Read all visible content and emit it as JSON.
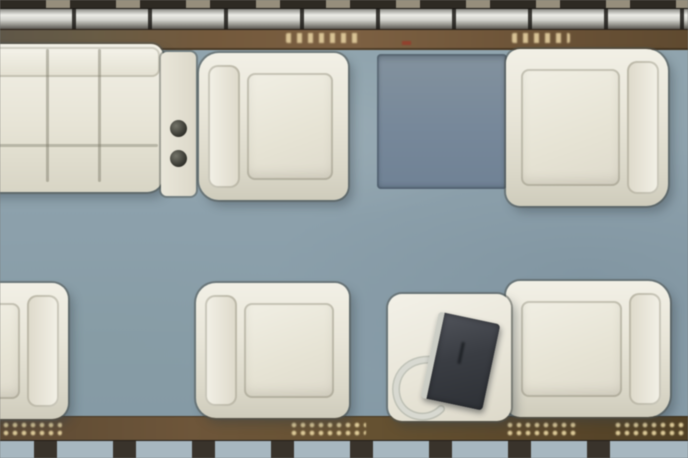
{
  "scene": {
    "type": "aircraft-cabin-floorplan",
    "view": "top-down"
  },
  "objects": {
    "sofa": {
      "label": "Divan sofa with three cushions"
    },
    "console": {
      "label": "Side console with two cup holders"
    },
    "table_panel": {
      "label": "Stowed table panel between facing seats"
    },
    "seat_top_mid": {
      "label": "Club seat, facing right"
    },
    "seat_top_right": {
      "label": "Club seat, facing left"
    },
    "seat_bottom_left": {
      "label": "Club seat, partially visible at left edge"
    },
    "seat_bottom_mid": {
      "label": "Club seat, facing right"
    },
    "side_table": {
      "label": "Table"
    },
    "laptop": {
      "label": "Dark laptop resting at an angle on table"
    },
    "seat_bottom_right": {
      "label": "Club seat, facing left"
    }
  },
  "structure": {
    "top": {
      "window_segments": 9,
      "rail": "metallic overhead rail",
      "sideboard": "wood sideboard with gilt markings"
    },
    "bottom": {
      "trim": "patterned wood trim with gilt motifs",
      "window_segments": 9
    }
  },
  "colors": {
    "carpet": "#8CA1AD",
    "upholstery": "#EBE8DA",
    "upholstery_shadow": "#D6D3C2",
    "wood": "#6F5638",
    "wood_dark": "#584527",
    "rail_metal": "#D6D6D1",
    "window_pane": "#A6B7C1",
    "window_frame": "#39332B",
    "table_panel": "#76889B",
    "laptop_body": "#3A3D43",
    "marking_gold": "#E4CE9C",
    "marking_red": "#93402C"
  }
}
